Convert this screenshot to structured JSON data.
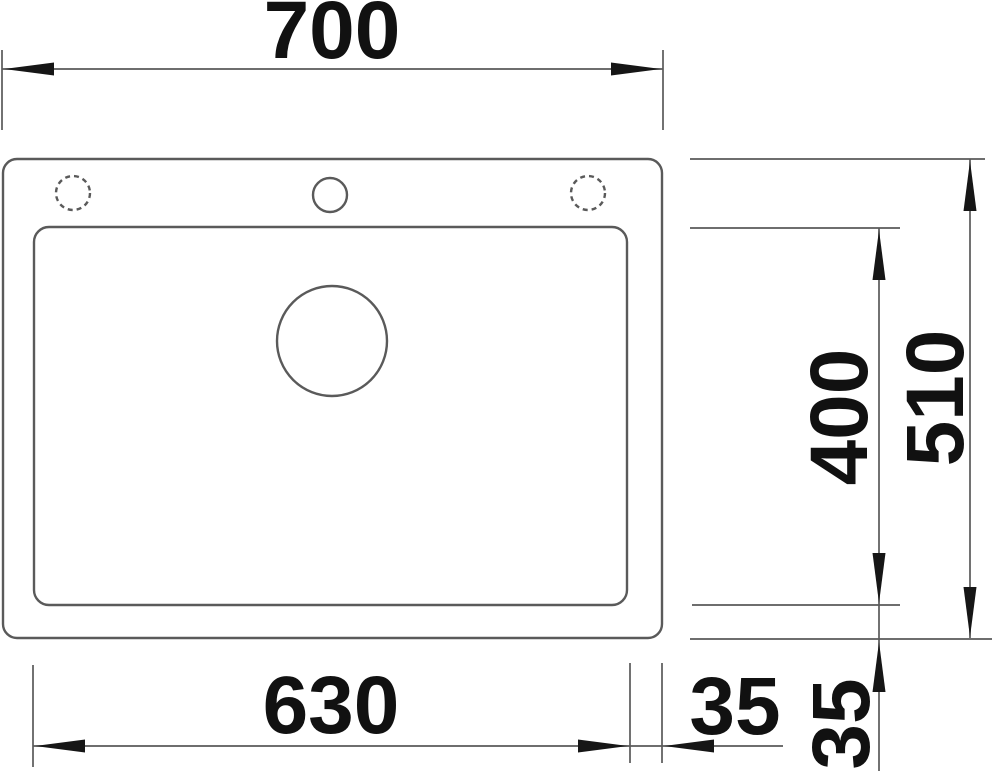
{
  "page": {
    "background": "#ffffff"
  },
  "drawing": {
    "type": "sink-top-view-technical-drawing",
    "line_color": "#5a5a5a",
    "arrow_color": "#161616",
    "text_color": "#111111",
    "labels": {
      "overall_width": "700",
      "overall_depth": "510",
      "bowl_depth": "400",
      "bowl_width": "630",
      "right_margin": "35",
      "bottom_margin": "35"
    }
  }
}
